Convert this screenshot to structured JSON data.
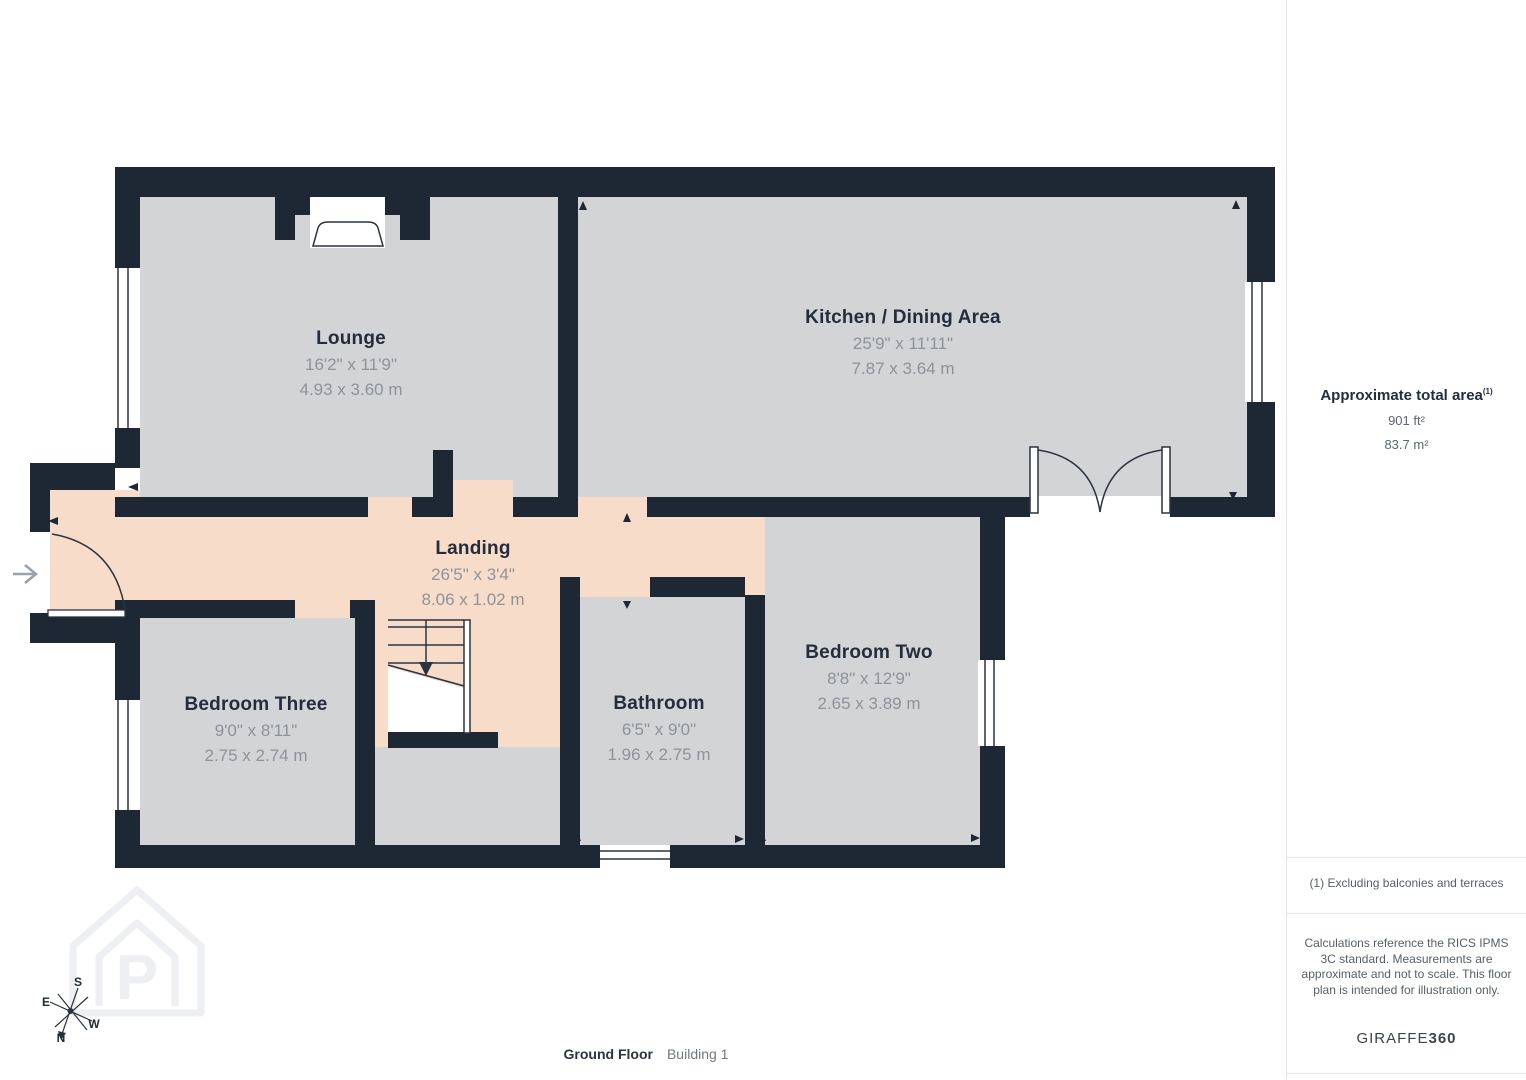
{
  "plan": {
    "rooms": [
      {
        "name": "Lounge",
        "imperial": "16'2\" x 11'9\"",
        "metric": "4.93 x 3.60 m"
      },
      {
        "name": "Kitchen / Dining Area",
        "imperial": "25'9\" x 11'11\"",
        "metric": "7.87 x 3.64 m"
      },
      {
        "name": "Landing",
        "imperial": "26'5\" x 3'4\"",
        "metric": "8.06 x 1.02 m"
      },
      {
        "name": "Bedroom Three",
        "imperial": "9'0\" x 8'11\"",
        "metric": "2.75 x 2.74 m"
      },
      {
        "name": "Bathroom",
        "imperial": "6'5\" x 9'0\"",
        "metric": "1.96 x 2.75 m"
      },
      {
        "name": "Bedroom Two",
        "imperial": "8'8\" x 12'9\"",
        "metric": "2.65 x 3.89 m"
      }
    ],
    "caption": {
      "floor": "Ground Floor",
      "building": "Building 1"
    },
    "compass": {
      "north": "N",
      "south": "S",
      "east": "E",
      "west": "W"
    }
  },
  "sidebar": {
    "area_title": "Approximate total area",
    "area_footnote_marker": "(1)",
    "area_imperial": "901 ft²",
    "area_metric": "83.7 m²",
    "footnote": "(1) Excluding balconies and terraces",
    "disclaimer": "Calculations reference the RICS IPMS 3C standard. Measurements are approximate and not to scale. This floor plan is intended for illustration only.",
    "brand_name": "GIRAFFE",
    "brand_suffix": "360"
  },
  "colors": {
    "wall": "#1e2834",
    "room_fill": "#d3d4d6",
    "landing_fill": "#f7dcc9",
    "title_text": "#232d3c",
    "dim_text": "#8d939b"
  }
}
